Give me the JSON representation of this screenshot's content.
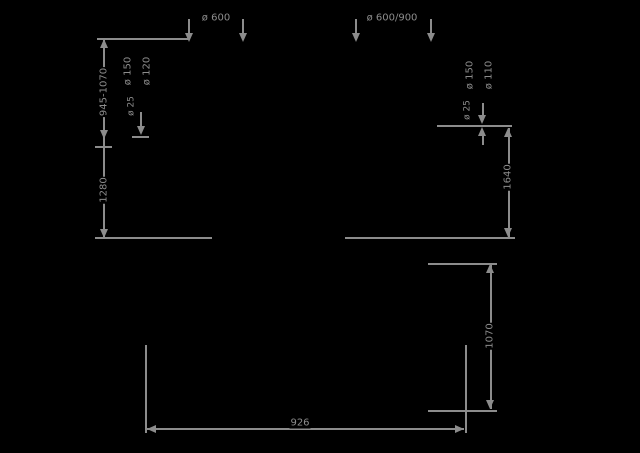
{
  "colors": {
    "background": "#000000",
    "line": "#8c8c8c"
  },
  "left_view": {
    "top_width": "ø 600",
    "duct_diameter_primary": "ø 150",
    "duct_diameter_secondary": "ø 120",
    "small_diameter": "ø 25",
    "chimney_height_range": "945-1070",
    "total_height": "1280"
  },
  "right_view": {
    "top_width": "ø 600/900",
    "duct_diameter_primary": "ø 150",
    "duct_diameter_secondary": "ø 110",
    "small_diameter": "ø 25",
    "height": "1640"
  },
  "bottom_view": {
    "width": "926",
    "height": "1070"
  }
}
